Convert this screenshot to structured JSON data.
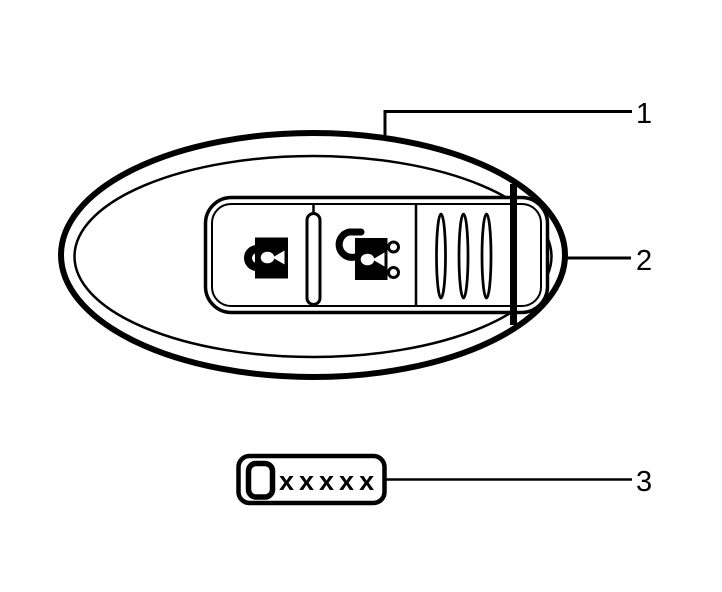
{
  "diagram": {
    "colors": {
      "line": "#000000",
      "background": "#ffffff"
    },
    "callouts": [
      {
        "number": "1"
      },
      {
        "number": "2"
      },
      {
        "number": "3"
      }
    ],
    "part_label_box": {
      "text": "xxxxx"
    },
    "icons": {
      "left_button": "lock-icon",
      "right_button": "unlock-icon"
    }
  }
}
